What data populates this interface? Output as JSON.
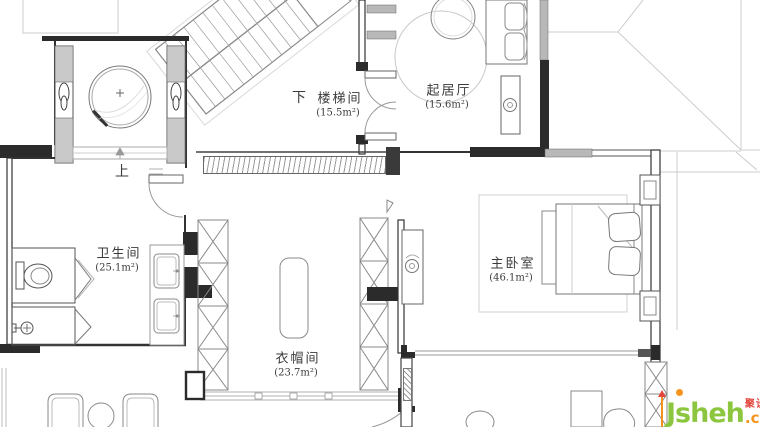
{
  "rooms": {
    "staircase": {
      "name": "楼梯间",
      "area": "(15.5m²)"
    },
    "living": {
      "name": "起居厅",
      "area": "(15.6m²)"
    },
    "bathroom": {
      "name": "卫生间",
      "area": "(25.1m²)"
    },
    "cloakroom": {
      "name": "衣帽间",
      "area": "(23.7m²)"
    },
    "master_bedroom": {
      "name": "主卧室",
      "area": "(46.1m²)"
    }
  },
  "labels": {
    "down": "下",
    "up": "上"
  },
  "watermark": {
    "j": "J",
    "sheh": "sheh",
    "com": ".com",
    "badge": "聚设汇"
  },
  "colors": {
    "wall": "#2b2b2b",
    "furniture_line": "#8a8a8a",
    "roof_line": "#cccccc",
    "logo_green": "#8CC63F",
    "logo_orange": "#F7941E",
    "logo_red": "#E2453C"
  }
}
